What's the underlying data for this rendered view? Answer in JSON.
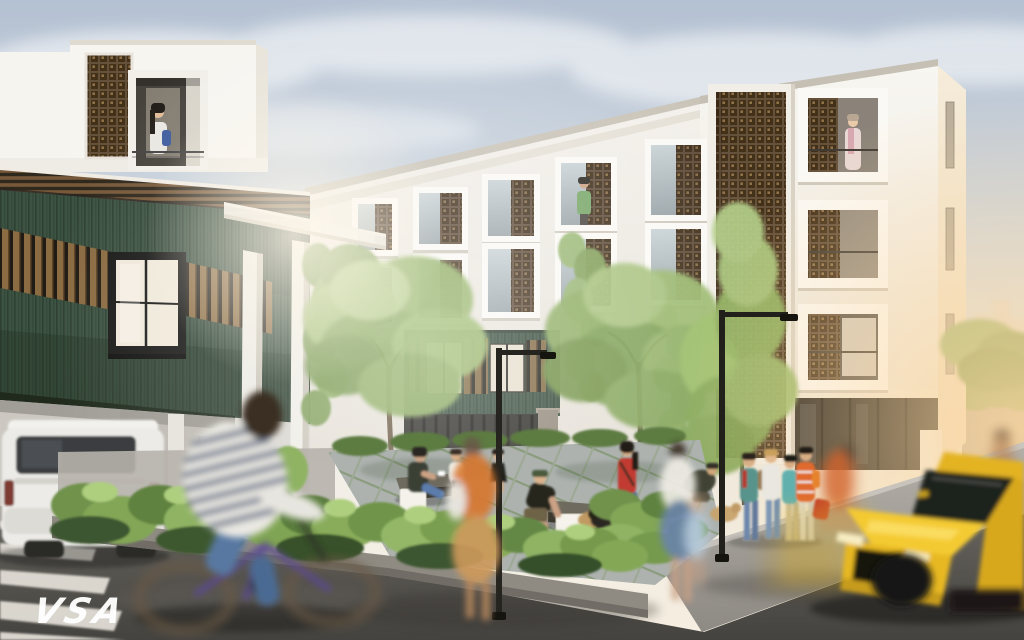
{
  "watermark": {
    "text": "VSA",
    "color": "#ffffff"
  },
  "scene": {
    "type": "architectural-rendering",
    "setting": "residential apartment complex with landscaped corner courtyard at street level",
    "time_of_day": "hazy warm daylight",
    "elements": {
      "white_apartment_building": "3-storey white block, deep square window frames, perforated clay breeze-block stair tower and window screens",
      "green_annex_building": "2-storey annex with dark green corrugated siding, timber slat screens, white penthouse box and carport",
      "courtyard": "planted corner plaza with diagonal pavers, benches, glowing cube lights and street lamps",
      "street": "asphalt road wrapping the plaza corner with zebra crosswalk",
      "vehicles": [
        "white SUV parked in carport",
        "yellow sports car in motion blur",
        "dark cars parked in background"
      ],
      "people": [
        "woman at penthouse window",
        "residents at apartment windows",
        "four students chatting on the sidewalk",
        "woman walking a dog",
        "woman seated on a bench",
        "man petting a dog",
        "children playing",
        "blurred cyclists and pedestrians in motion"
      ]
    },
    "palette": {
      "sky_blue": "#b4c1d2",
      "sunset_glow": "#f6d7ae",
      "facade_white": "#f5f3ef",
      "siding_green": "#3d5342",
      "breeze_block_brown": "#65503a",
      "timber_slat": "#8a6b42",
      "foliage_green": "#8fae63",
      "paver_grey": "#a4aaa6",
      "asphalt_grey": "#4a4845",
      "car_yellow": "#f0c52a"
    }
  }
}
